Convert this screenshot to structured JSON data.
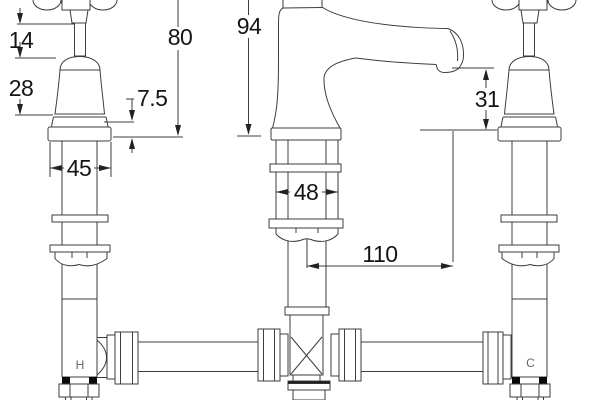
{
  "drawing": {
    "dimensions": {
      "d14": "14",
      "d28": "28",
      "d80": "80",
      "d94": "94",
      "d75": "7.5",
      "d45": "45",
      "d48": "48",
      "d31": "31",
      "d110": "110"
    },
    "labels": {
      "hot": "H",
      "cold": "C"
    }
  }
}
